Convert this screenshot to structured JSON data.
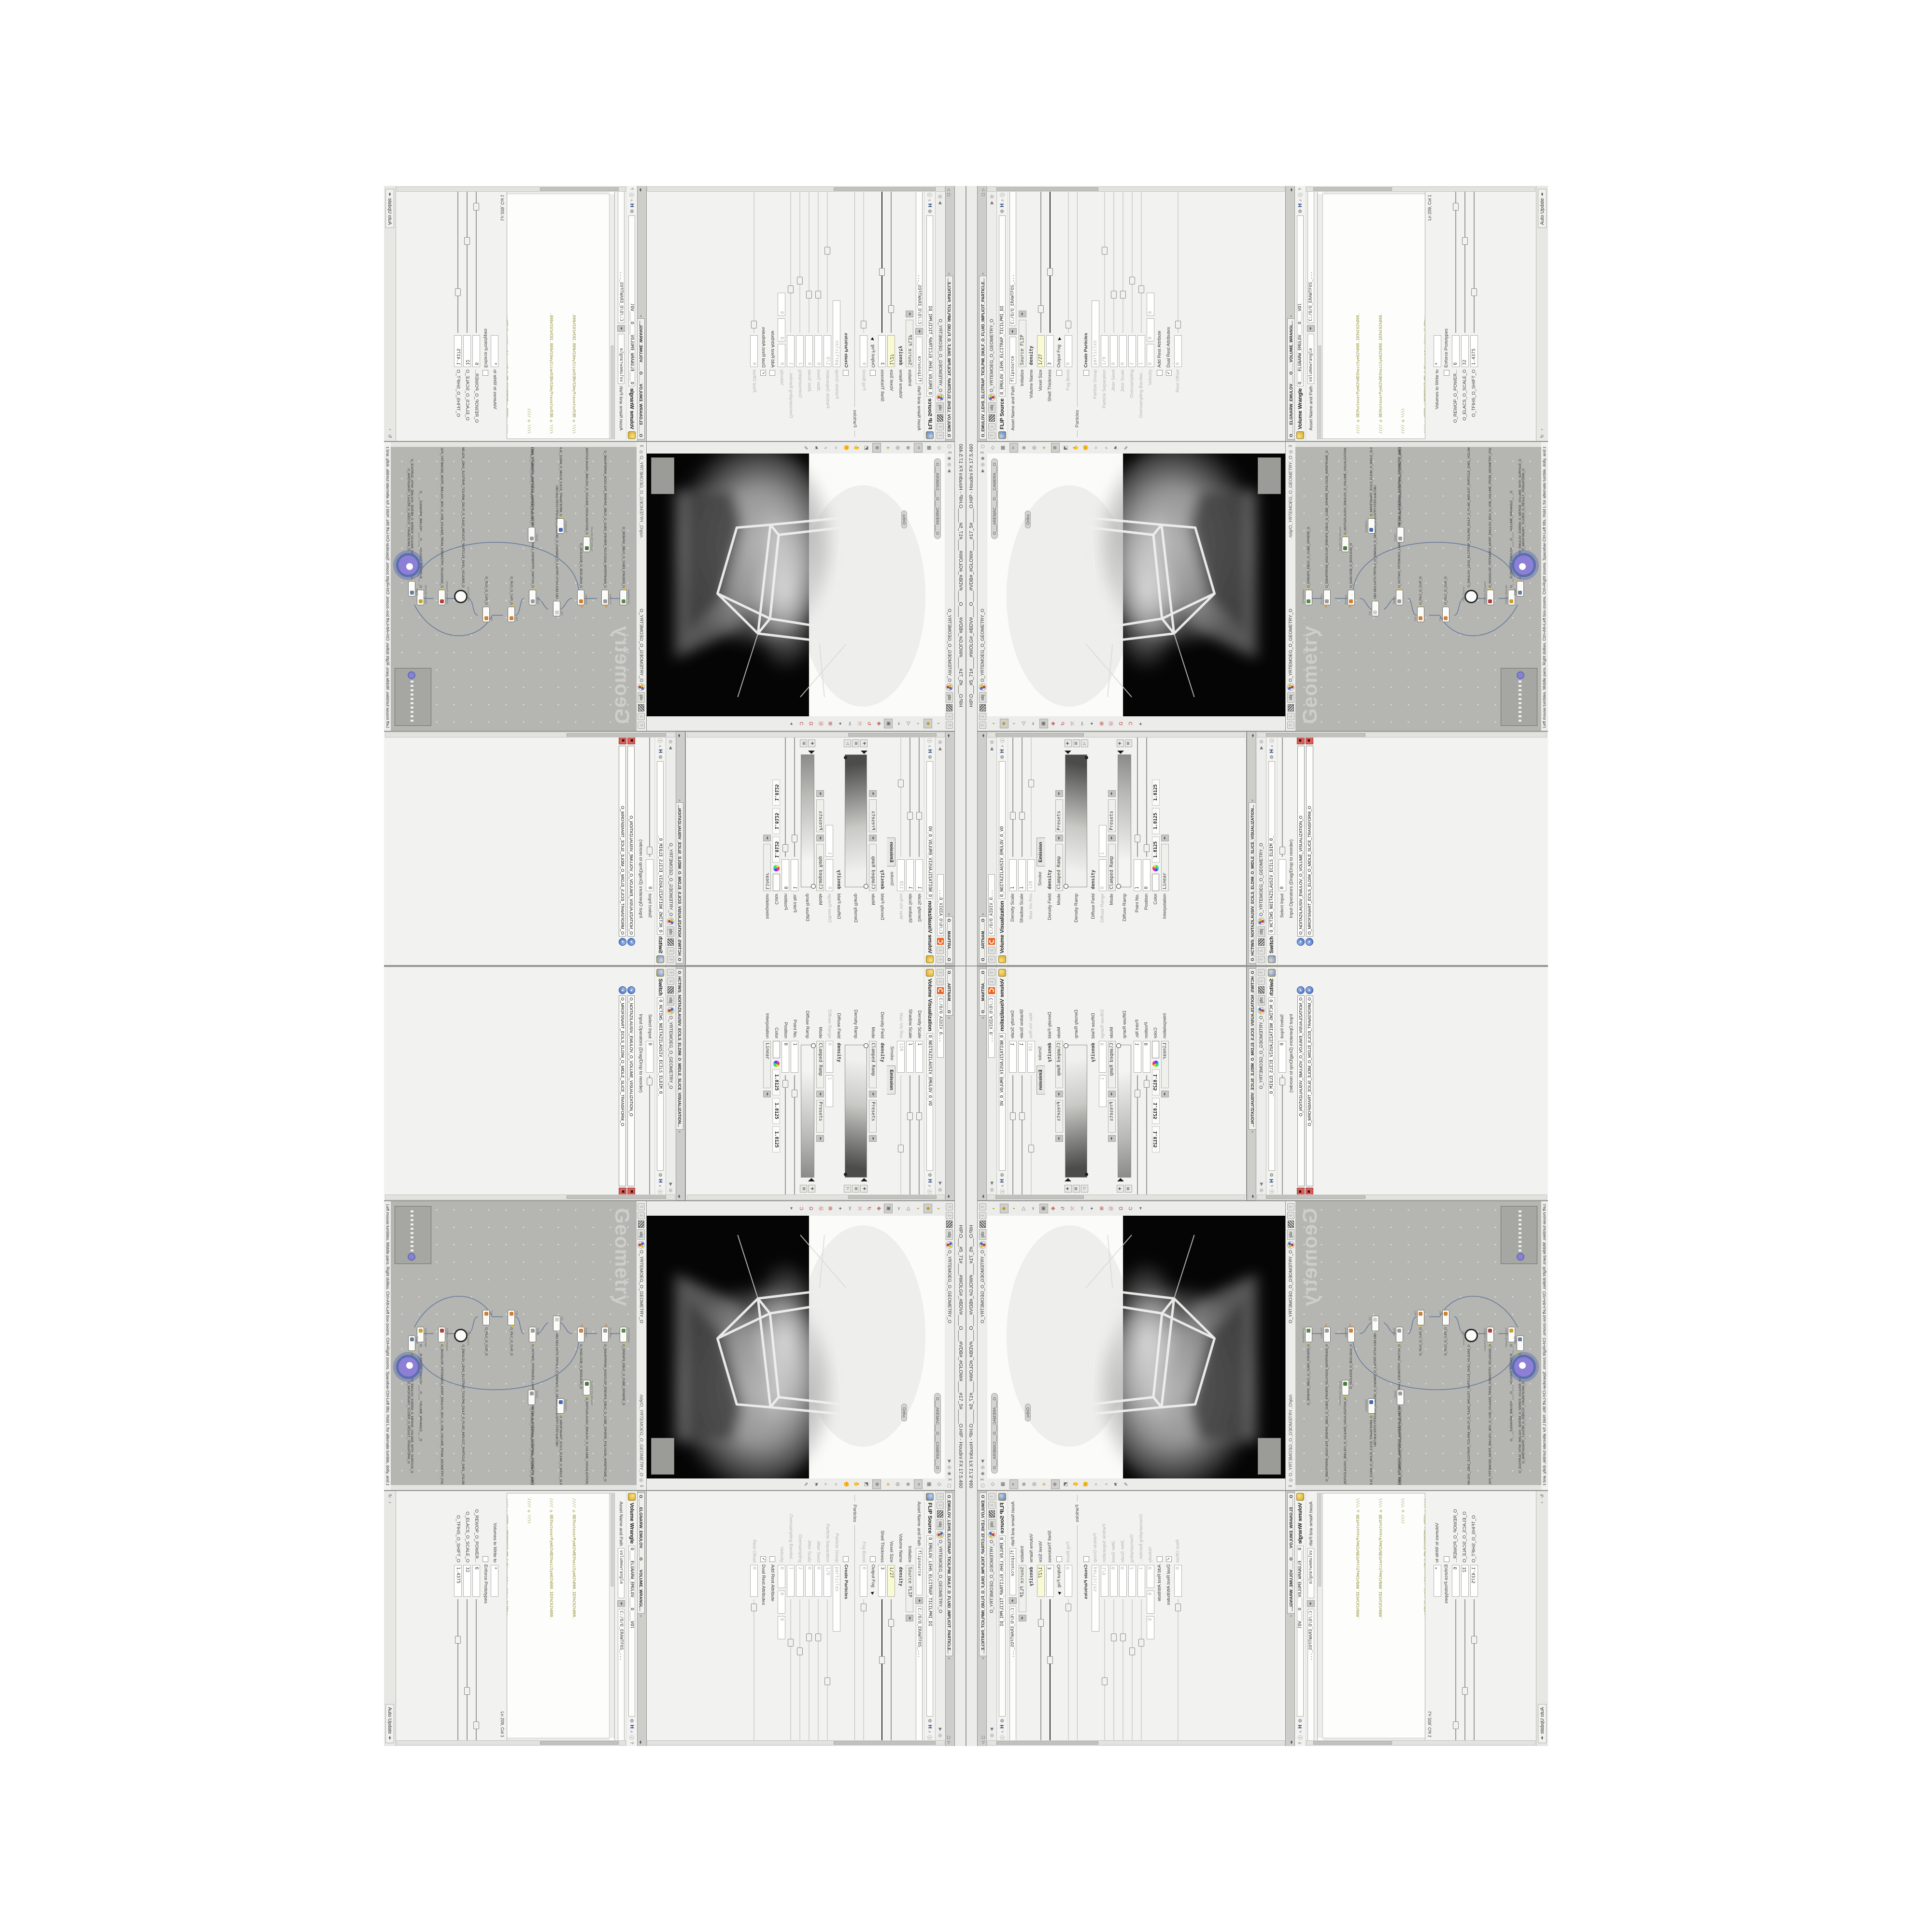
{
  "window": {
    "title": "HIP.O___#5_71#____#WOLG#_#BDV#____O____#VDB#_#GLOW#____#17_5#_____O.HIP - Houdini FX 17.5.460"
  },
  "shared": {
    "obj_tab": "obj",
    "geo_path": "O_YRTEMOEG_O_GEOMETRY_O",
    "softwarepath": "C:/O/O_ERAWTFOS_..."
  },
  "flip": {
    "tab": "O_EMULOV_LEHS_ELCITRAP_TICILPMI_DIULF_O_FLUID_IMPLICIT_PARTICLE...",
    "type": "FLIP Source",
    "name": "O_EMULOV_LEHS_ELCITRAP_TICILPMI_DI",
    "asset_label": "Asset Name and Path",
    "asset_name": "flipsource",
    "rows": [
      {
        "label": "Initialize",
        "value": "Source FLIP"
      },
      {
        "label": "Volume Name",
        "value": "density"
      },
      {
        "label": "Voxel Size",
        "value": "1/27"
      },
      {
        "label": "Shell Thickness",
        "value": "3"
      },
      {
        "label": "Output Fog",
        "value": ""
      },
      {
        "label": "Fog Boost",
        "value": "0"
      },
      {
        "label": "Create Particles",
        "value": ""
      },
      {
        "label": "Particle Group",
        "value": "particles"
      },
      {
        "label": "Particle Separation",
        "value": "1/9"
      },
      {
        "label": "Jitter Seed",
        "value": "0"
      },
      {
        "label": "Jitter Scale",
        "value": "0"
      },
      {
        "label": "Oversampling",
        "value": "2"
      },
      {
        "label": "Oversampling Bandwi...",
        "value": "1"
      },
      {
        "label": "Velocity",
        "value": "0",
        "value2": "0",
        "value3": "0"
      },
      {
        "label": "Add Rest Attribute",
        "value": ""
      },
      {
        "label": "Dual Rest Attributes",
        "value": ""
      },
      {
        "label": "Rest Offset",
        "value": "0"
      }
    ],
    "section": "Particles"
  },
  "wrangle": {
    "tab": "O____ELGNARW_EMULOV____O____VOLUME_WRANGL...",
    "type": "Volume Wrangle",
    "name": "O____ELGNARW_EMULOV____O____VOl",
    "asset_label": "Asset Name and Path",
    "asset_name": "volumewrangle",
    "code": {
      "c1": "//// ◎ 0D3%steserPym62%0D3%eziSym62%000.1D3%C62%000.",
      "c2": "//// ◎ 0D3%steserPym62%0D3%eziSym62%000.1D3%C62%000.",
      "c3": "//// ◎ \\\\\\\\",
      "c4": "//// ◎ HTTP://MEMORYST◎MP.C◎M/graphtoy/#draw1%3Dtru",
      "c5": "//// ◎ HTTP://MEMORYST◎MP.C◎M/graphtoy/#draw1%3Dtru",
      "m1": "@density=((        ((",
      "kw1": "pow",
      "m2": "((      1./ (1.-",
      "kw2": "cla"
    },
    "cursor_pos": "Ln 209, Col 1",
    "volumes_label": "Volumes to Write to",
    "volumes_value": "*",
    "enforce": "Enforce Prototypes",
    "sliders": [
      {
        "label": "O_REWOP_O_POWER...",
        "value": "6"
      },
      {
        "label": "O_ELACS_O_SCALE_O",
        "value": "32"
      },
      {
        "label": "O_TFIHS_O_SHIFT_O",
        "value": "1.4375"
      }
    ],
    "auto_update": "Auto Update"
  },
  "viz": {
    "mantra_tab": "O____ARTNAM____O",
    "mantra_path": "C:/O/O_AIDIV_O...",
    "type": "Volume Visualization",
    "name": "O_NOITAZILAUSIV_EMULOV_O_VO",
    "rows": [
      {
        "label": "Density Scale",
        "value": "1"
      },
      {
        "label": "Shadow Scale",
        "value": "1"
      },
      {
        "label": "Max Vis Res",
        "value": "128"
      },
      {
        "label": "Density Field",
        "value": "density"
      },
      {
        "label": "Mode",
        "value": "Clamped Ramp",
        "presets": "Presets"
      },
      {
        "label": "Density Ramp",
        "value": ""
      },
      {
        "label": "Diffuse Field",
        "value": "density"
      },
      {
        "label": "Diffuse Range",
        "value": "0",
        "value2": "1"
      },
      {
        "label": "Mode",
        "value": "Clamped Ramp",
        "presets": "Presets"
      },
      {
        "label": "Diffuse Ramp",
        "value": ""
      },
      {
        "label": "Point No.",
        "value": "1"
      },
      {
        "label": "Position",
        "value": "0"
      },
      {
        "label": "Color",
        "r": "1.8125",
        "g": "1.8125",
        "b": "1.8125"
      },
      {
        "label": "Interpolation",
        "value": "Linear"
      }
    ],
    "tabs": [
      "Smoke",
      "Emission"
    ]
  },
  "switch": {
    "tab": "O_HCTIWS_NOITAZILAUSIV_ECILS_ELDIM_O_MIDLE_SLICE_VISUALIZATION...",
    "type": "Switch",
    "name": "O_HCTIWS_NOITAZILAUSIV_ECILS_ELDIM_O_",
    "select_label": "Select Input",
    "select_value": "0",
    "ops_label": "Input Operators (Drag/Drop to reorder)",
    "items": [
      "O_NOITAZILAUSIV_EMULOV_O_VOLUME_VISUALIZATION_O",
      "O_MROFSNART_ECILS_ELDIM_O_MIDLE_SLICE_TRANSFORM_O"
    ]
  },
  "viewport": {
    "camera": "O___AREMAC___O___CAMERA___O",
    "ortho": "Ortho",
    "icons_right": [
      "layout-icon",
      "geometry-cube-icon",
      "camera-lock-icon",
      "shade-icon",
      "headlight-icon",
      "light-icon",
      "zoom-region-icon",
      "view-cube-icon",
      "tumble-hand-icon",
      "dolly-hand-icon",
      "key-icon",
      "magnify-icon",
      "flag-icon",
      "pen-icon"
    ],
    "icons_left": [
      "mouse-left-icon",
      "mouse-middle-icon",
      "mouse-right-icon",
      "back-icon",
      "select-cursor-icon",
      "select-mode-icon",
      "translate-gizmo-icon",
      "rotate-gizmo-icon",
      "scale-gizmo-icon",
      "cut-icon",
      "axis-icon",
      "snap-grid-icon",
      "snap-point-icon",
      "snap-edge-icon",
      "snap-curve-icon",
      "more-icon"
    ]
  },
  "network": {
    "tab": "O_YRTEMOEG_O_GEOMETRY_O",
    "right_path": "/obj/O_YRTEMOEG_O_GEOMETRY_O",
    "watermark": "Geometry",
    "status": "Left mouse tumbles. Middle pans. Right dollies. Ctrl+Alt+Left box-zooms. Ctrl+Right zooms. Spacebar-Ctrl-Left tilts. Hold L for alternate tumble, dolly, and zoom.",
    "nodes": [
      {
        "t": "CubeSphere",
        "n": "O_EREHPS_EBUC_O_CUBE_SPHERE_O",
        "c": "#5a8a4a"
      },
      {
        "t": "PolyWire",
        "n": "O_EMARFERIW_NOGYLOP_EREHPS_EBUC_O_CUBE_SPHERE_POLYGON_WIREFRAME_O",
        "c": "#9a9a98"
      },
      {
        "t": "Boolean",
        "n": "O_NAELOOB_O_BOOLEAN_O",
        "c": "#d08030"
      },
      {
        "t": "File",
        "n": "OBJ.ND1.PETS.TRFOLS_O_55MOEG_O_GEOM55_O.SLOFRT.STEP.1DN.OBJ",
        "c": "#cfcfc8"
      },
      {
        "t": "Switch",
        "n": "O_HCTIWS_YRTEMOEG_LANRETXE_LANRETNI_O_INTERNAL_EXTERNAL_GEOMETRY_SWITCH_O",
        "c": "#9a9a98"
      },
      {
        "t": "Clip",
        "n": "O_PILC_O_CLIP_O",
        "c": "#d08030"
      },
      {
        "t": "Clip",
        "n": "O_PILC_O_CLIP_O",
        "c": "#d08030"
      },
      {
        "t": "FLIP Source",
        "n": "O_EMULOV_LEHS_ELCITRAP_TICILPMI_DIULF_O_FLUID_IMPLICIT_PARTICLE_SHEL_VOLUME_O",
        "c": "#fdfdfc"
      },
      {
        "t": "VDB from Polygons",
        "n": "O_SNOGILOP_YRTEMOEG_MORF_EMULOV_BDV_O_VDB_VOLUME_FROM_GEOMETRY_POLYGONS_O",
        "c": "#b04038"
      },
      {
        "t": "Volume Wrangle",
        "n": "O____ELGNARW_EMULOV____O____VOLUME_WRANGLE____O",
        "c": "#c8a32c"
      },
      {
        "t": "Volume Visualization",
        "n": "O_NOITAZILAUSIV_EMULOV_O_VOLUME_VISUALIZATION_O",
        "c": "#4a7a40"
      },
      {
        "t": "Transform",
        "n": "O_MROFSNART_ECILS_ELDIM_O_MIDLE_SLICE_TRANSFORM_O",
        "c": "#4868b0"
      },
      {
        "t": "Switch",
        "n": "O_HCTIWS_NOITAZILAUSIV_ECILS_ELDIM_O_MIDLE_SLICE_VISUALIZATION_SWITCH_O",
        "c": "#9a9a98"
      },
      {
        "t": "Merge",
        "n": "O_ECAFRUS_HTIW_EMULOV_EGREM_O_MERGE_VOLUME_WITH_SURFACE_O",
        "c": "#6a7a9a"
      },
      {
        "t": "Transform",
        "n": "O_MROFSNART_TLUSER_O_RESULT_TRANSFORM_O",
        "c": "#8d7fd6"
      }
    ]
  },
  "colors": {
    "accent_orange": "#e8611c",
    "selected_node": "#8d7fd6",
    "selected_ring": "#5b6fae",
    "yellow_field": "#fafad2",
    "code_comment": "#8f8f2e",
    "code_keyword": "#1f7f94",
    "network_bg": "#b5b5b2"
  }
}
